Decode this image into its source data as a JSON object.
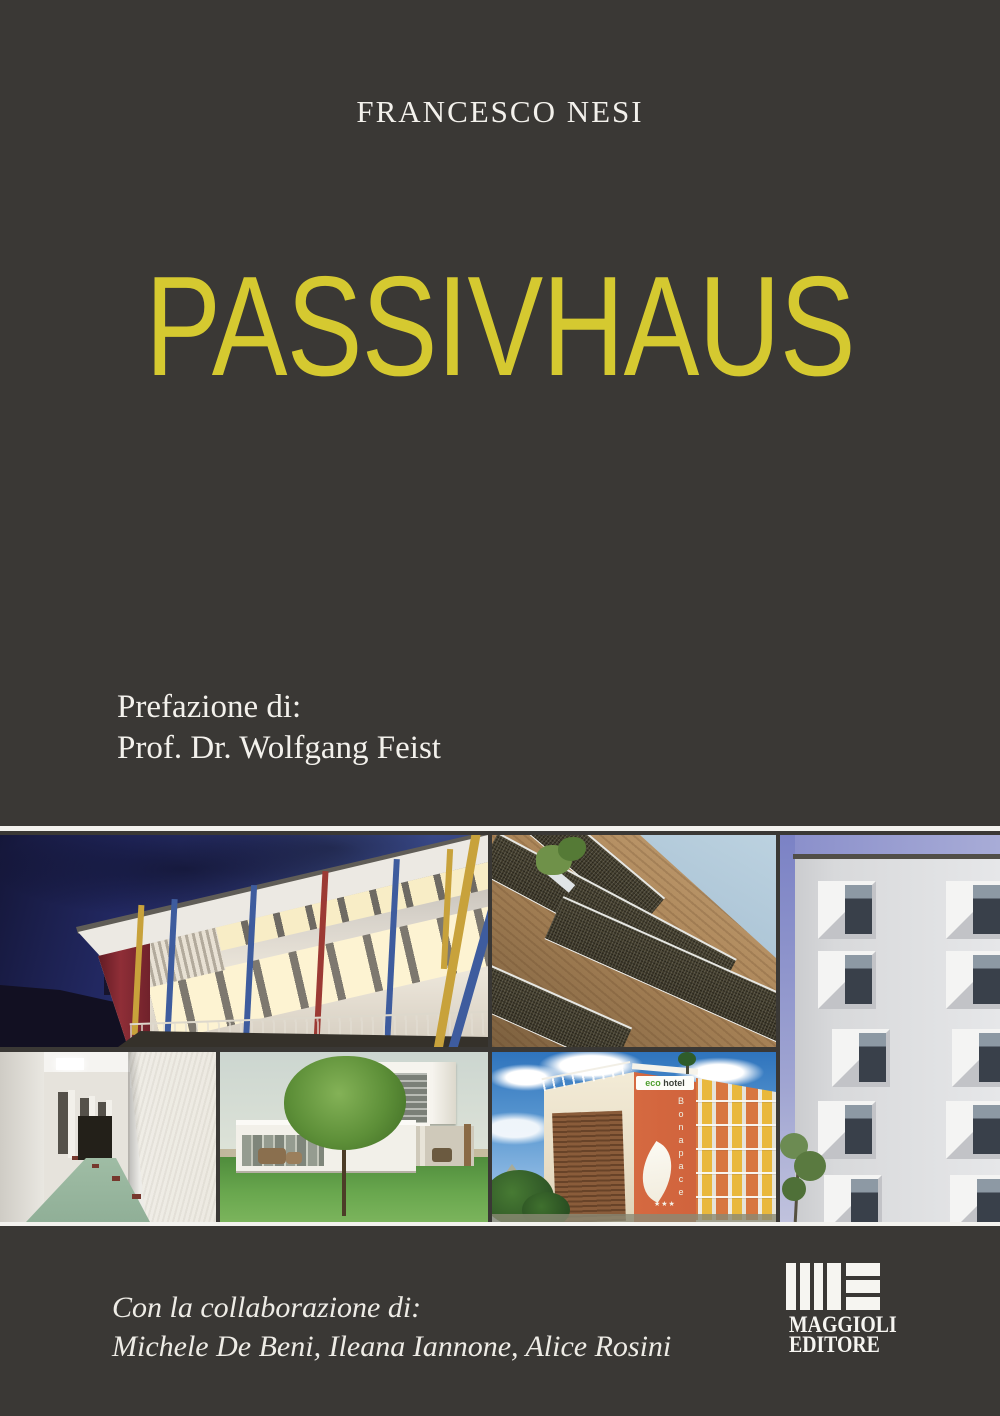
{
  "colors": {
    "background": "#3a3835",
    "title": "#d5c930",
    "rule": "#f3f2ee",
    "text": "#f3f1ec"
  },
  "author": "FRANCESCO NESI",
  "title": "PASSIVHAUS",
  "preface": {
    "label": "Prefazione di:",
    "name": "Prof. Dr. Wolfgang Feist"
  },
  "collaboration": {
    "label": "Con la collaborazione di:",
    "names": "Michele De Beni, Ileana Iannone, Alice Rosini"
  },
  "publisher": {
    "name": "MAGGIOLI",
    "type": "EDITORE"
  },
  "photos": {
    "school": {
      "alt": "Modern passive school building at dusk with glowing windows, coloured pillars and church tower silhouette"
    },
    "wood_facade": {
      "alt": "Timber facade with dark metal mesh shading panels seen from below against blue sky"
    },
    "white_facade": {
      "alt": "White facade with deep-set angled square windows and violet sky strip"
    },
    "corridor": {
      "alt": "White rough-plaster corridor with green floor"
    },
    "house": {
      "alt": "Modern white passive house with round tree and lawn"
    },
    "hotel": {
      "alt": "Eco hotel Bonapace with orange facade, leaf logo and coloured balconies",
      "sign_eco": "eco",
      "sign_hotel": "hotel",
      "sign_vertical": "Bonapace",
      "stars": "★★★"
    }
  }
}
